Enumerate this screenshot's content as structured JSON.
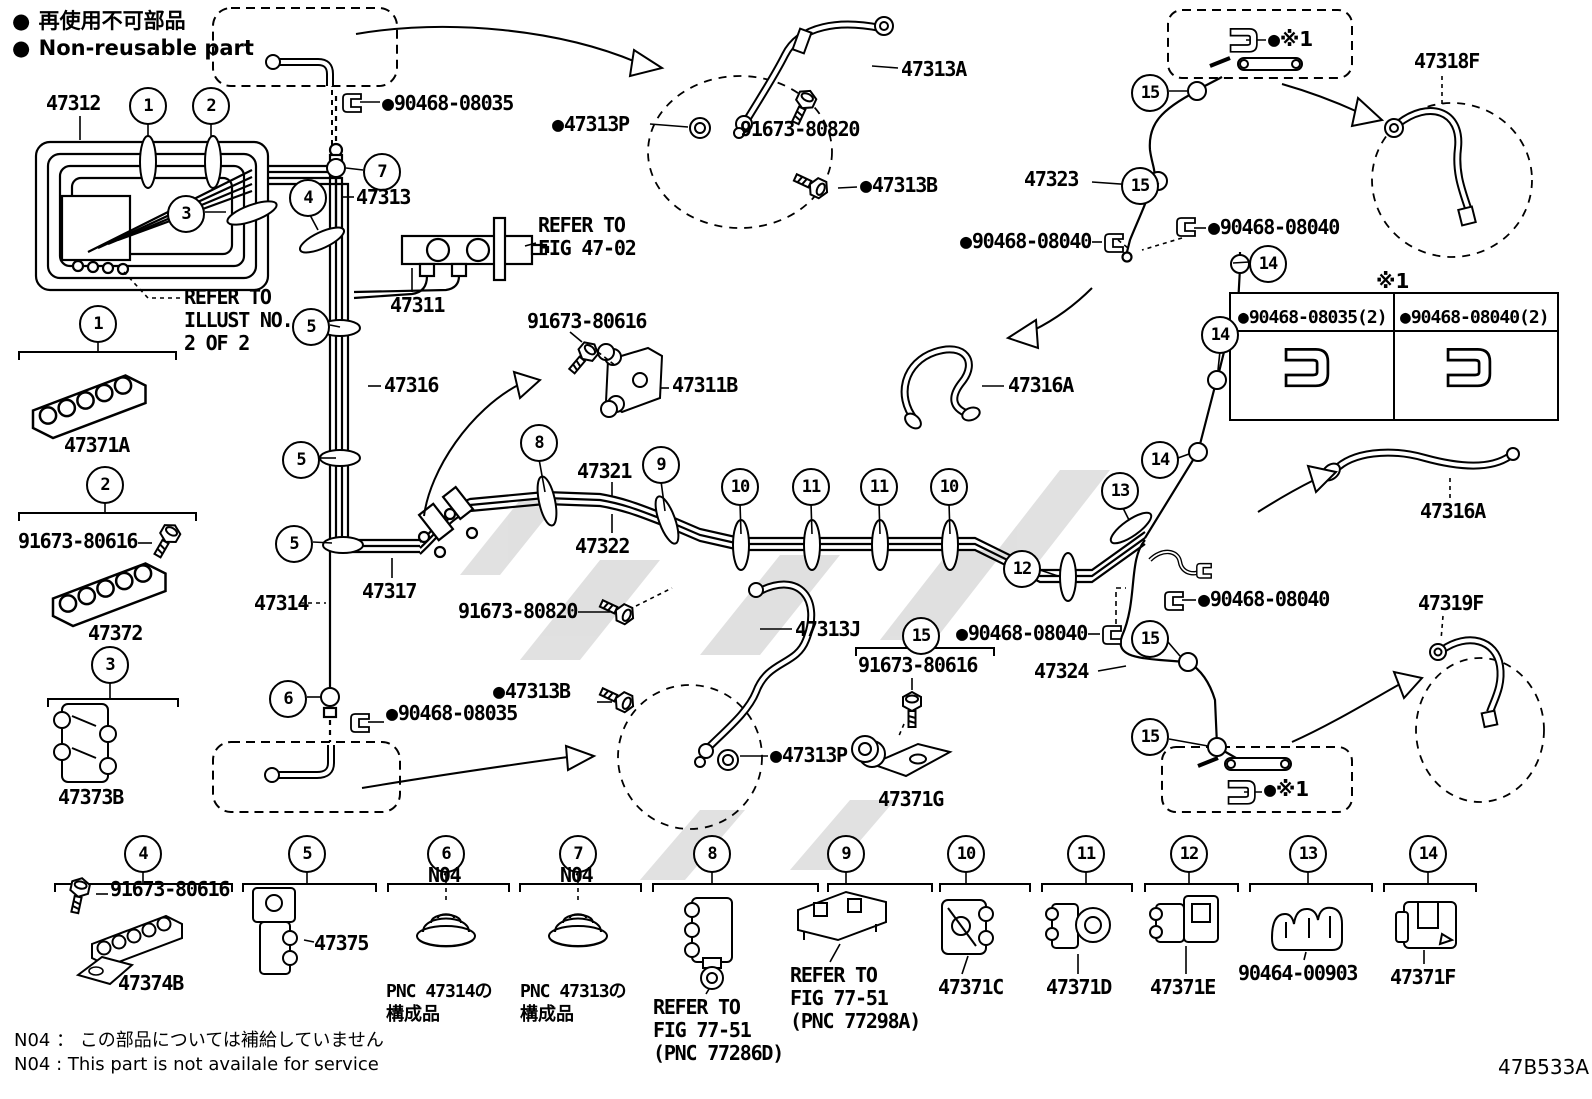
{
  "legend": {
    "nonreusable_jp": "再使用不可部品",
    "nonreusable_en": "Non-reusable part"
  },
  "marks": {
    "bullet": "●",
    "x1": "※1"
  },
  "parts": {
    "p47312": "47312",
    "p47313": "47313",
    "p47313a": "47313A",
    "p47313b": "47313B",
    "p47313j": "47313J",
    "p47313p": "47313P",
    "p47311": "47311",
    "p47311b": "47311B",
    "p47314": "47314",
    "p47316": "47316",
    "p47316a": "47316A",
    "p47317": "47317",
    "p47318f": "47318F",
    "p47319f": "47319F",
    "p47321": "47321",
    "p47322": "47322",
    "p47323": "47323",
    "p47324": "47324",
    "p47371a": "47371A",
    "p47371c": "47371C",
    "p47371d": "47371D",
    "p47371e": "47371E",
    "p47371f": "47371F",
    "p47371g": "47371G",
    "p47372": "47372",
    "p47373b": "47373B",
    "p47374b": "47374B",
    "p47375": "47375",
    "p90464": "90464-00903",
    "p90468_08035": "90468-08035",
    "p90468_08035_2": "90468-08035(2)",
    "p90468_08040": "90468-08040",
    "p90468_08040_2": "90468-08040(2)",
    "p91673_80616": "91673-80616",
    "p91673_80820": "91673-80820",
    "n04": "N04"
  },
  "refs": {
    "refer_to": "REFER TO",
    "fig_47_02": "FIG 47-02",
    "illust_no": "ILLUST NO.",
    "two_of_2": "2 OF 2",
    "fig_77_51": "FIG 77-51",
    "pnc_77286d": "(PNC 77286D)",
    "pnc_77298a": "(PNC 77298A)",
    "pnc_47314": "PNC 47314の",
    "pnc_47313": "PNC 47313の",
    "component": "構成品"
  },
  "callouts": {
    "c1": "1",
    "c2": "2",
    "c3": "3",
    "c4": "4",
    "c5": "5",
    "c6": "6",
    "c7": "7",
    "c8": "8",
    "c9": "9",
    "c10": "10",
    "c11": "11",
    "c12": "12",
    "c13": "13",
    "c14": "14",
    "c15": "15"
  },
  "notes": {
    "jp": "N04 ： この部品については補給していません",
    "en": "N04 :  This part is not availale for service"
  },
  "doc_code": "47B533A"
}
